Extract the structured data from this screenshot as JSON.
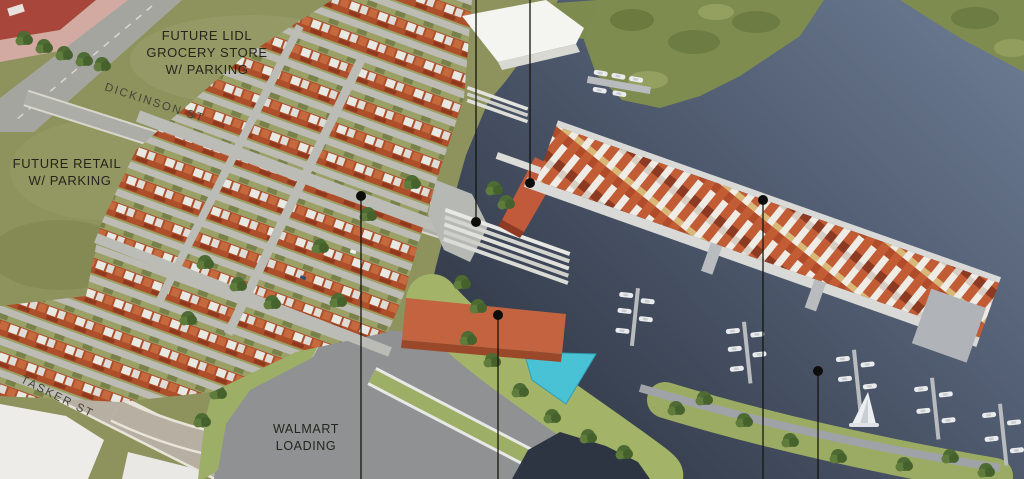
{
  "title": "Waterfront master plan aerial rendering",
  "labels": {
    "future_lidl": {
      "line1": "FUTURE LIDL",
      "line2": "GROCERY STORE",
      "line3": "W/ PARKING"
    },
    "future_retail": {
      "line1": "FUTURE RETAIL",
      "line2": "W/ PARKING"
    },
    "walmart_loading": {
      "line1": "WALMART",
      "line2": "LOADING"
    },
    "streets": {
      "dickinson": "DICKINSON ST",
      "tasker": "TASKER ST"
    }
  },
  "callouts": [
    {
      "name": "callout-townhome-block",
      "x": 361,
      "dot_y": 196,
      "line_from": 196,
      "line_to": 479
    },
    {
      "name": "callout-waterfront-plaza",
      "x": 476,
      "dot_y": 222,
      "line_from": 0,
      "line_to": 222
    },
    {
      "name": "callout-pier-building",
      "x": 530,
      "dot_y": 183,
      "line_from": 0,
      "line_to": 183
    },
    {
      "name": "callout-retail-building",
      "x": 498,
      "dot_y": 315,
      "line_from": 315,
      "line_to": 479
    },
    {
      "name": "callout-floating-homes",
      "x": 763,
      "dot_y": 200,
      "line_from": 200,
      "line_to": 479
    },
    {
      "name": "callout-marina",
      "x": 818,
      "dot_y": 371,
      "line_from": 371,
      "line_to": 479
    }
  ],
  "colors": {
    "grass": "#8e935d",
    "marsh": "#7e8d4f",
    "esplanade": "#9fb066",
    "asphalt": "#8f9193",
    "street_tan": "#b6afa2",
    "parcel_white": "#edece8",
    "plaza_gray": "#b6b8b4",
    "pond_cyan": "#49c2d6",
    "retail_building_red": "#c4633f",
    "pier_building_red": "#c05a3a",
    "supermarket_white": "#f4f4f1",
    "dock_gray": "#b9bcbe",
    "label_text": "#25251e"
  }
}
